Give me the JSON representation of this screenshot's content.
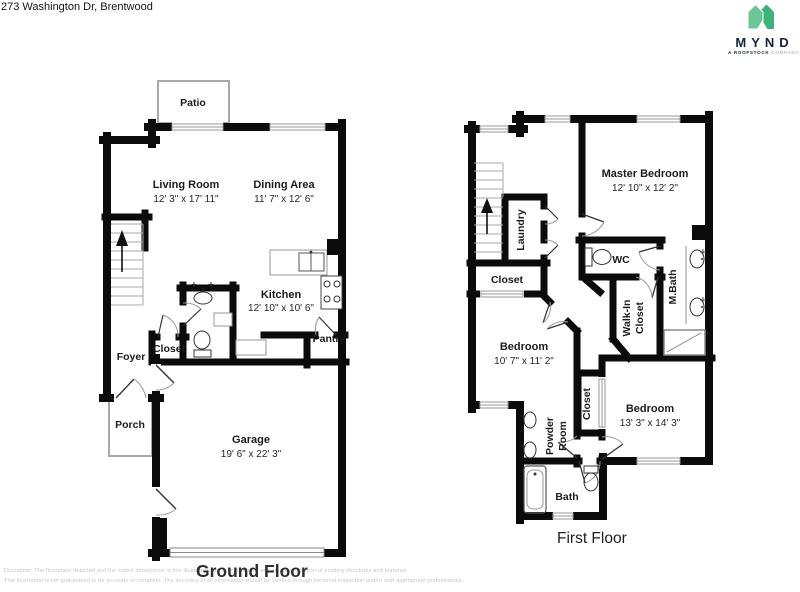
{
  "header": {
    "address": "273 Washington Dr, Brentwood"
  },
  "logo": {
    "brand": "MYND",
    "tagline_bold": "A ROOFSTOCK",
    "tagline_light": "COMPANY",
    "green_light": "#6cc694",
    "green_dark": "#3fb27b",
    "navy": "#16233e"
  },
  "ground_floor": {
    "title": "Ground Floor",
    "rooms": {
      "patio": {
        "name": "Patio"
      },
      "living": {
        "name": "Living Room",
        "dims": "12' 3\" x 17' 11\""
      },
      "dining": {
        "name": "Dining Area",
        "dims": "11' 7\" x 12' 6\""
      },
      "kitchen": {
        "name": "Kitchen",
        "dims": "12' 10\" x 10' 6\""
      },
      "pantry": {
        "name": "Pantry"
      },
      "closet": {
        "name": "Closet"
      },
      "foyer": {
        "name": "Foyer"
      },
      "porch": {
        "name": "Porch"
      },
      "garage": {
        "name": "Garage",
        "dims": "19' 6\" x 22' 3\""
      }
    }
  },
  "first_floor": {
    "title": "First Floor",
    "rooms": {
      "master": {
        "name": "Master Bedroom",
        "dims": "12' 10\" x 12' 2\""
      },
      "laundry": {
        "name": "Laundry"
      },
      "closet_hall": {
        "name": "Closet"
      },
      "wc": {
        "name": "WC"
      },
      "mbath": {
        "name": "M.Bath"
      },
      "walkin": {
        "line1": "Walk-In",
        "line2": "Closet"
      },
      "bedroom_a": {
        "name": "Bedroom",
        "dims": "10' 7\" x 11' 2\""
      },
      "closet_mid": {
        "name": "Closet"
      },
      "bedroom_b": {
        "name": "Bedroom",
        "dims": "13' 3\" x 14' 3\""
      },
      "powder": {
        "line1": "Powder",
        "line2": "Room"
      },
      "bath": {
        "name": "Bath"
      }
    }
  },
  "disclaimer": {
    "line1": "Disclaimer: The floorplans depicted and the stated dimensions in this illustration are indicative only and an approximation of existing structures and features.",
    "line2": "This illustration is not guaranteed to be accurate or complete. The accuracy of all information should be verified through personal inspection and/or with appropriate professionals."
  }
}
